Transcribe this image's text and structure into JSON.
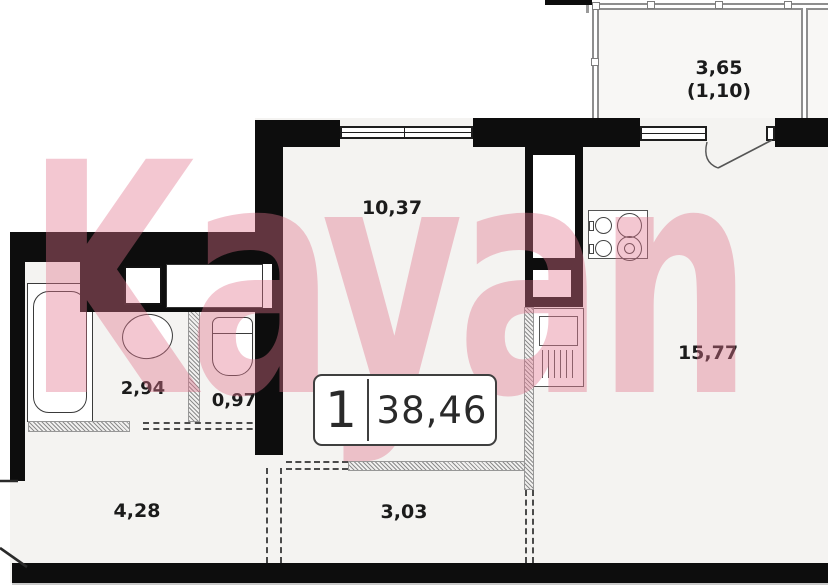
{
  "watermark": "Kayan",
  "badge": {
    "rooms": "1",
    "area": "38,46"
  },
  "areas": {
    "living": "10,37",
    "balcony": "3,65",
    "balcony_reduced": "(1,10)",
    "room_main": "15,77",
    "bathroom": "2,94",
    "wc": "0,97",
    "hallway": "4,28",
    "corridor": "3,03"
  },
  "colors": {
    "wall": "#0d0d0d",
    "watermark_pink": "#e0748b",
    "hatch_gray": "#8d8d8d",
    "floor": "#f4f3f1"
  }
}
